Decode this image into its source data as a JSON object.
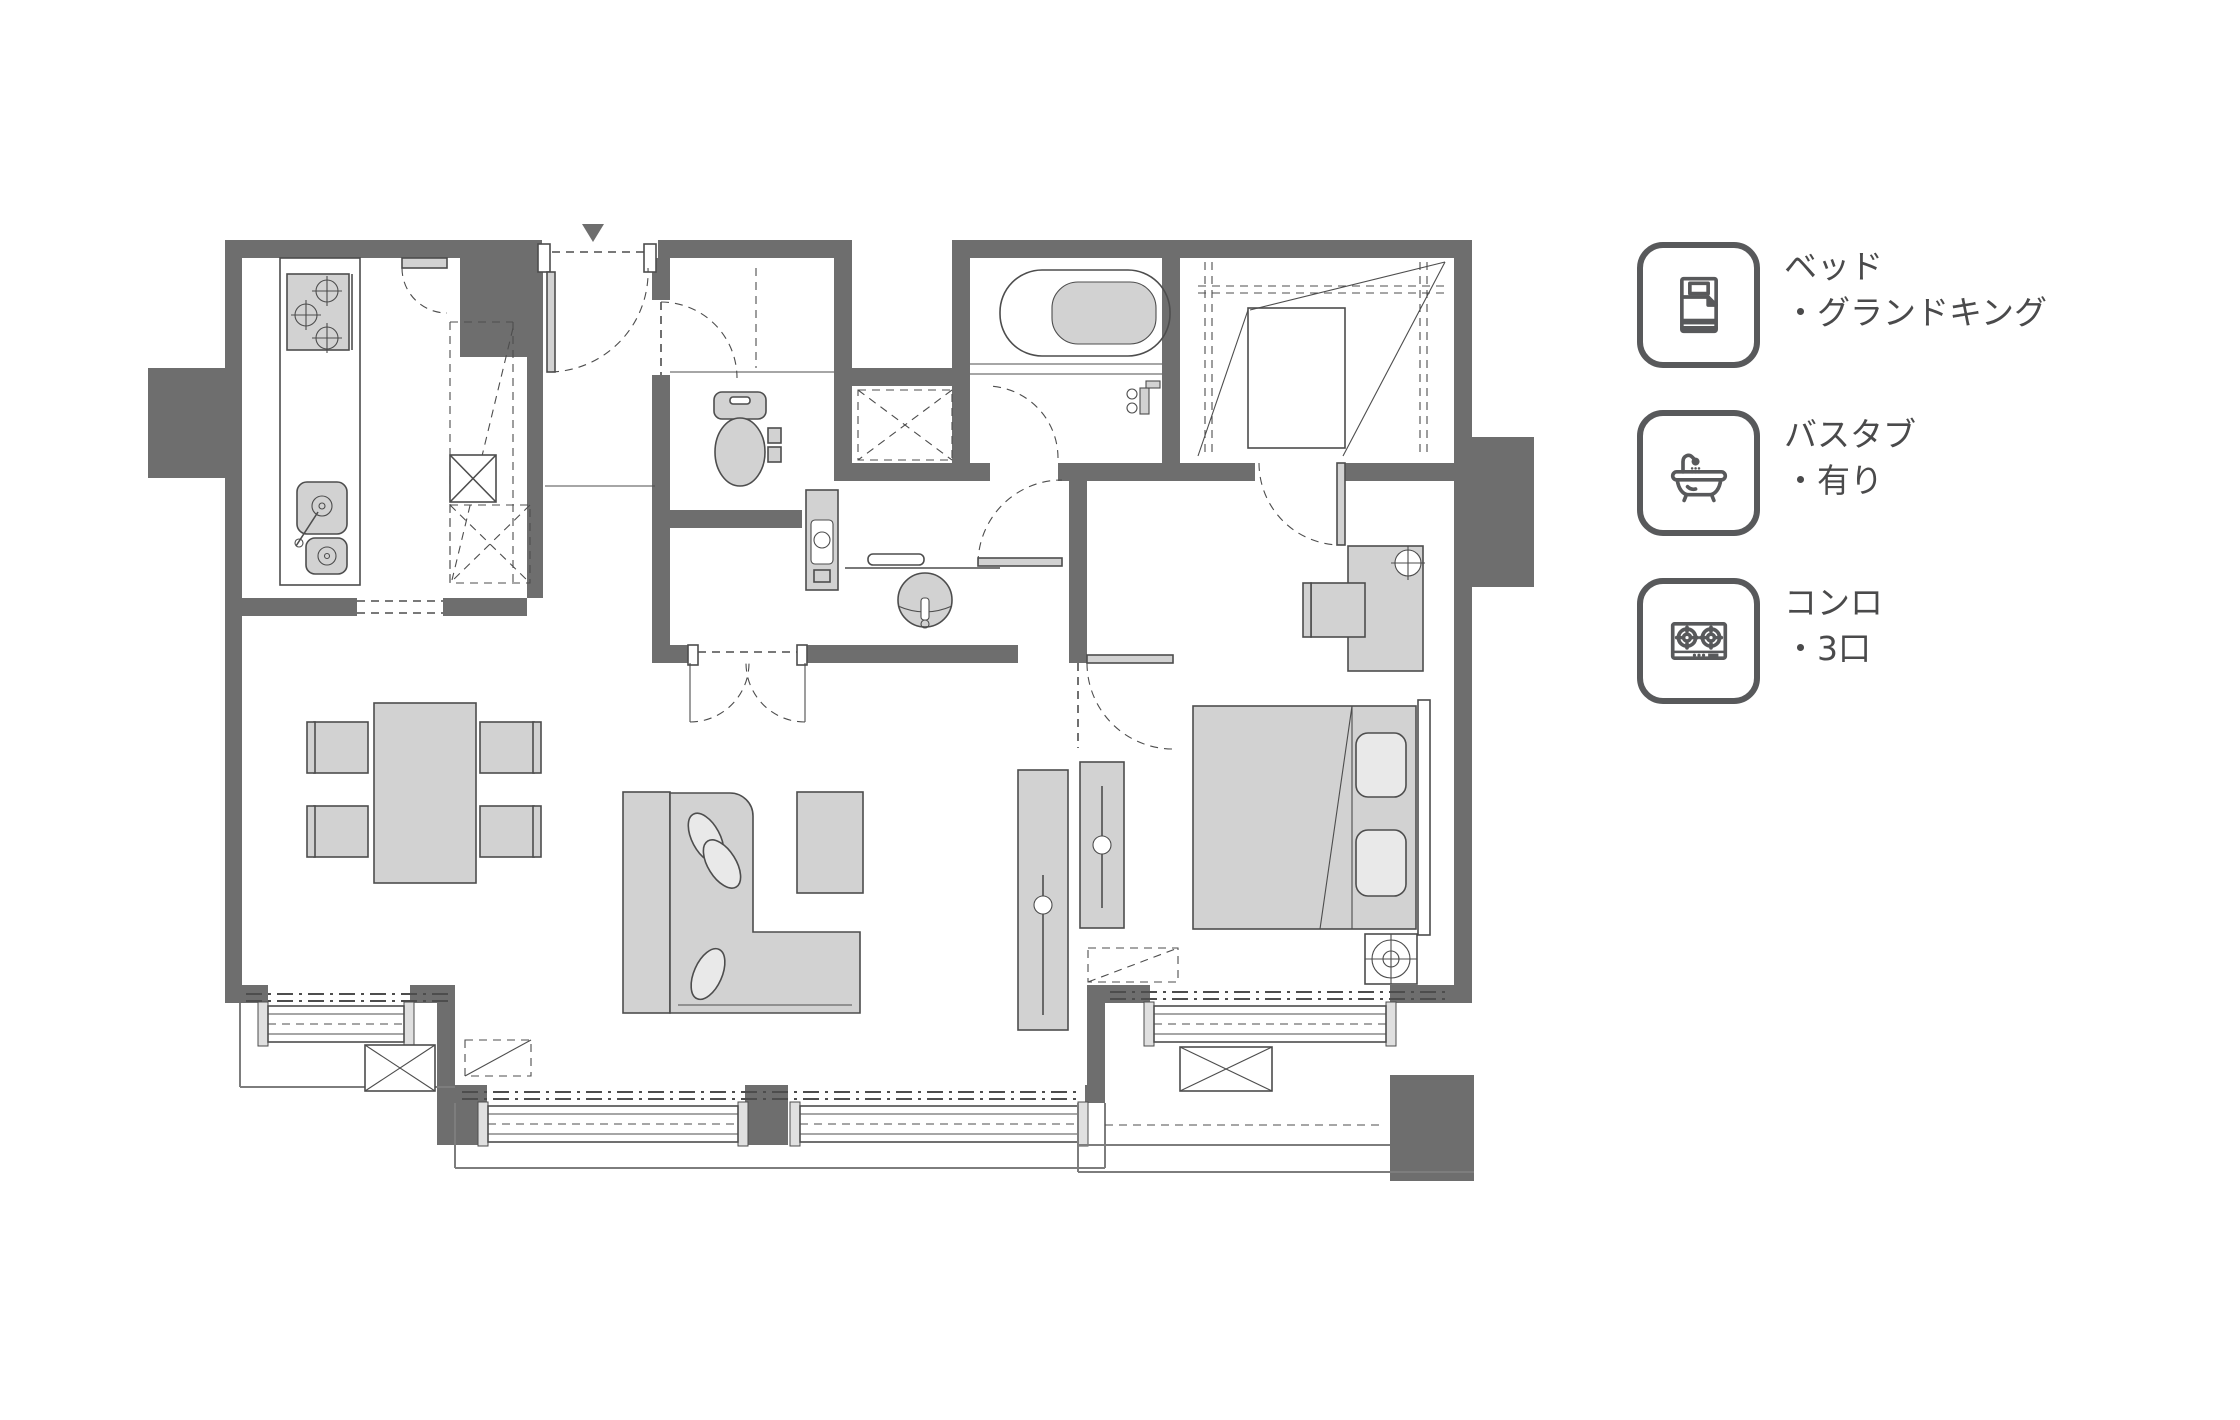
{
  "legend": {
    "text_color": "#4a4a4b",
    "icon_color": "#58595b",
    "items": [
      {
        "icon": "bed-icon",
        "title": "ベッド",
        "detail": "・グランドキング"
      },
      {
        "icon": "bathtub-icon",
        "title": "バスタブ",
        "detail": "・有り"
      },
      {
        "icon": "stove-icon",
        "title": "コンロ",
        "detail": "・3口"
      }
    ]
  },
  "floor_plan": {
    "colors": {
      "wall": "#6e6e6e",
      "line": "#4d4d4d",
      "furniture": "#d2d2d2",
      "fixture": "#cfcfcf",
      "soft": "#e9e9e9",
      "background": "#ffffff"
    },
    "symbols": [
      "entrance-arrow",
      "stove-3-burner",
      "kitchen-sink",
      "refrigerator-space",
      "toilet",
      "washer-space",
      "washbasin",
      "bathtub",
      "shower-mixer",
      "walk-in-closet",
      "king-bed",
      "pillows",
      "desk",
      "desk-chair",
      "ceiling-light",
      "tv-board",
      "l-shaped-sofa",
      "coffee-table",
      "dining-table",
      "dining-chair",
      "window",
      "curtain-rail",
      "balcony",
      "ac-outdoor-unit"
    ]
  }
}
